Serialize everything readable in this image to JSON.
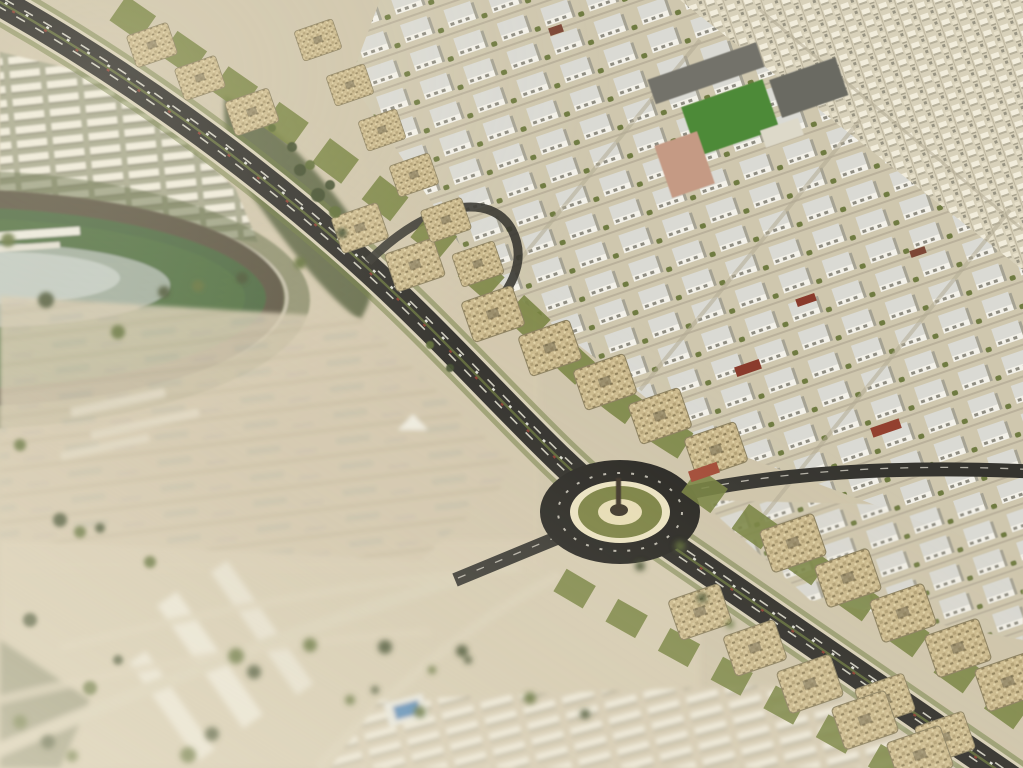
{
  "scene": {
    "description": "Aerial 3D masterplan rendering of a desert city: a dark diagonal boulevard lined with beige apartment clusters and green landscaped wedges runs from the top-left to the bottom-right through an oval roundabout with an olive-green center island and monument; a dense district of white mid-rise blocks and a vast low-rise villa fabric fills the upper right; a green racetrack oval with an infield lake sits at the left edge; blurred sandy lots, faint parcel lines, long white warehouse rows and scattered dark trees fill the out-of-focus lower-left foreground",
    "style": "tilt-shift architectural visualization, no text or UI elements",
    "palette": {
      "sand": "#cfc5ab",
      "sandLight": "#d8cdb4",
      "asphalt": "#2c2b27",
      "asphaltDark": "#23221f",
      "paleRoad": "#d8d0b7",
      "laneWhite": "#e9e6d8",
      "verdeGreen": "#707c42",
      "wedgeGreen": "#76823f",
      "darkTree": "#3f4c2a",
      "oliveTree": "#5c6b35",
      "trackDirt": "#57503c",
      "infield": "#44633a",
      "lake": "#aab5ad",
      "beigeCluster": "#cbb98c",
      "whiteBlock": "#f2f0e8",
      "roofGray": "#dadad4",
      "schoolRoof": "#6f6e66",
      "fieldGreen": "#4e8a39",
      "salmon": "#c59a84",
      "poolBlue": "#4f86b8",
      "islandCream": "#ece4c2",
      "islandOlive": "#7a8142",
      "redAccent": "#8a3b2c"
    },
    "landmarks": [
      "main-boulevard",
      "central-roundabout",
      "monument-sculpture",
      "racetrack-oval",
      "infield-lake",
      "grandstand",
      "school-complex-with-sports-field",
      "midrise-apartment-district",
      "villa-fabric",
      "warehouse-rows",
      "apartment-clusters",
      "green-wedges",
      "swimming-pool",
      "desert-lots"
    ],
    "trees": [
      [
        8,
        240,
        7,
        "L"
      ],
      [
        46,
        300,
        8,
        "L"
      ],
      [
        118,
        332,
        7,
        "L"
      ],
      [
        164,
        292,
        6,
        "L"
      ],
      [
        198,
        286,
        6,
        "L"
      ],
      [
        242,
        278,
        6,
        "L"
      ],
      [
        300,
        263,
        6,
        "L"
      ],
      [
        342,
        233,
        5,
        "L"
      ],
      [
        20,
        445,
        6,
        "L"
      ],
      [
        60,
        520,
        7,
        "L"
      ],
      [
        80,
        532,
        6,
        "L"
      ],
      [
        100,
        528,
        5,
        "L"
      ],
      [
        150,
        562,
        6,
        "L"
      ],
      [
        30,
        620,
        7,
        "L"
      ],
      [
        90,
        688,
        7,
        "L"
      ],
      [
        118,
        660,
        5,
        "L"
      ],
      [
        188,
        755,
        8,
        "B"
      ],
      [
        212,
        734,
        7,
        "B"
      ],
      [
        236,
        656,
        8,
        "B"
      ],
      [
        254,
        672,
        7,
        "B"
      ],
      [
        310,
        645,
        7,
        "B"
      ],
      [
        385,
        647,
        7,
        "B"
      ],
      [
        420,
        712,
        6,
        "B"
      ],
      [
        462,
        651,
        6,
        "B"
      ],
      [
        530,
        698,
        6,
        "B"
      ],
      [
        585,
        714,
        5,
        "B"
      ],
      [
        350,
        700,
        5,
        "B"
      ],
      [
        375,
        690,
        4,
        "B"
      ],
      [
        432,
        670,
        4,
        "B"
      ],
      [
        468,
        660,
        4,
        "B"
      ],
      [
        20,
        722,
        7,
        "B"
      ],
      [
        48,
        742,
        7,
        "B"
      ],
      [
        72,
        756,
        6,
        "B"
      ],
      [
        640,
        566,
        5,
        "B"
      ],
      [
        680,
        546,
        5,
        "B"
      ],
      [
        702,
        598,
        5,
        "B"
      ],
      [
        730,
        624,
        4,
        "B"
      ],
      [
        330,
        185,
        5,
        "C"
      ],
      [
        310,
        165,
        5,
        "C"
      ],
      [
        292,
        147,
        5,
        "C"
      ],
      [
        272,
        128,
        4,
        "C"
      ],
      [
        318,
        195,
        7,
        "C"
      ],
      [
        335,
        212,
        6,
        "C"
      ],
      [
        300,
        170,
        6,
        "C"
      ],
      [
        430,
        345,
        4,
        "C"
      ],
      [
        450,
        368,
        4,
        "C"
      ]
    ],
    "clusters": [
      [
        152,
        45,
        0.8
      ],
      [
        200,
        78,
        0.8
      ],
      [
        252,
        112,
        0.85
      ],
      [
        360,
        228,
        0.9
      ],
      [
        415,
        265,
        0.95
      ],
      [
        318,
        40,
        0.75
      ],
      [
        350,
        85,
        0.75
      ],
      [
        382,
        130,
        0.75
      ],
      [
        414,
        175,
        0.78
      ],
      [
        446,
        220,
        0.8
      ],
      [
        478,
        264,
        0.82
      ],
      [
        493,
        314,
        1
      ],
      [
        550,
        348,
        1
      ],
      [
        605,
        382,
        1
      ],
      [
        660,
        416,
        1
      ],
      [
        716,
        450,
        1
      ],
      [
        793,
        543,
        1.05
      ],
      [
        848,
        578,
        1.05
      ],
      [
        903,
        613,
        1.05
      ],
      [
        958,
        648,
        1.05
      ],
      [
        1008,
        682,
        1.05
      ],
      [
        885,
        700,
        0.95
      ],
      [
        945,
        738,
        0.95
      ],
      [
        700,
        612,
        1
      ],
      [
        755,
        648,
        1
      ],
      [
        810,
        684,
        1.05
      ],
      [
        865,
        720,
        1.05
      ],
      [
        920,
        755,
        1.05
      ]
    ],
    "accents": [
      [
        748,
        368,
        26,
        10,
        "#8a3b2c"
      ],
      [
        806,
        300,
        20,
        8,
        "#8a3b2c"
      ],
      [
        886,
        428,
        30,
        10,
        "#93402f"
      ],
      [
        556,
        30,
        14,
        8,
        "#7d4736"
      ],
      [
        918,
        252,
        16,
        7,
        "#7d4736"
      ],
      [
        704,
        472,
        30,
        11,
        "#a34a36"
      ]
    ]
  }
}
